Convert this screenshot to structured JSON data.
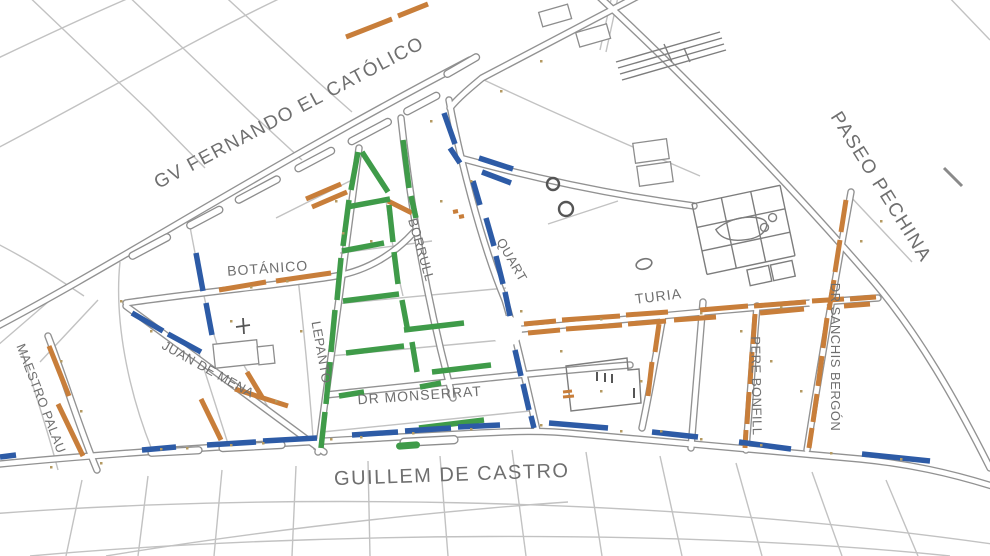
{
  "map": {
    "labels": {
      "gv": {
        "text": "GV FERNANDO EL CATÓLICO"
      },
      "pechina": {
        "text": "PASEO PECHINA"
      },
      "botanico": {
        "text": "BOTÁNICO"
      },
      "borrull": {
        "text": "BORRULL"
      },
      "quart": {
        "text": "QUART"
      },
      "lepanto": {
        "text": "LEPANTO"
      },
      "juan_de_mena": {
        "text": "JUAN DE MENA"
      },
      "maestro_palau": {
        "text": "MAESTRO PALAU"
      },
      "dr_monserrat": {
        "text": "DR MONSERRAT"
      },
      "turia": {
        "text": "TURIA"
      },
      "pere_bonfill": {
        "text": "PERE BONFILL"
      },
      "dr_sanchis_bergon": {
        "text": "DR SANCHIS BERGÓN"
      },
      "guillem_de_castro": {
        "text": "GUILLEM DE CASTRO"
      }
    },
    "colors": {
      "orange": "#c87e3a",
      "green": "#3f9b49",
      "blue": "#2d5ba6",
      "street_gray": "#929292",
      "label_gray": "#6f6f6f"
    },
    "segments": {
      "orange": [
        [
          346,
          37,
          392,
          19
        ],
        [
          398,
          16,
          428,
          4
        ],
        [
          306,
          199,
          341,
          184
        ],
        [
          312,
          207,
          347,
          192
        ],
        [
          219,
          290,
          266,
          282
        ],
        [
          276,
          281,
          331,
          273
        ],
        [
          388,
          201,
          412,
          213
        ],
        [
          49,
          346,
          69,
          396
        ],
        [
          58,
          404,
          83,
          456
        ],
        [
          201,
          399,
          221,
          440
        ],
        [
          235,
          389,
          288,
          406
        ],
        [
          247,
          372,
          262,
          397
        ],
        [
          524,
          324,
          556,
          321
        ],
        [
          562,
          320,
          620,
          316
        ],
        [
          626,
          315,
          668,
          312
        ],
        [
          700,
          310,
          748,
          306
        ],
        [
          754,
          306,
          806,
          302
        ],
        [
          812,
          301,
          844,
          299
        ],
        [
          850,
          299,
          876,
          297
        ],
        [
          528,
          333,
          560,
          330
        ],
        [
          566,
          329,
          622,
          325
        ],
        [
          628,
          324,
          666,
          321
        ],
        [
          674,
          320,
          716,
          317
        ],
        [
          760,
          313,
          804,
          309
        ],
        [
          844,
          306,
          870,
          304
        ],
        [
          846,
          200,
          841,
          232
        ],
        [
          840,
          240,
          835,
          272
        ],
        [
          834,
          280,
          829,
          310
        ],
        [
          827,
          318,
          823,
          348
        ],
        [
          822,
          356,
          818,
          386
        ],
        [
          817,
          394,
          813,
          422
        ],
        [
          812,
          428,
          809,
          448
        ],
        [
          755,
          314,
          753,
          344
        ],
        [
          752,
          352,
          750,
          384
        ],
        [
          749,
          392,
          747,
          424
        ],
        [
          746,
          430,
          745,
          448
        ],
        [
          659,
          324,
          655,
          352
        ],
        [
          652,
          362,
          648,
          396
        ],
        [
          453,
          212,
          458,
          211,
          4
        ],
        [
          459,
          217,
          464,
          216,
          4
        ],
        [
          563,
          392,
          572,
          391,
          3
        ],
        [
          563,
          397,
          574,
          396,
          3
        ]
      ],
      "green": [
        [
          358,
          152,
          351,
          190
        ],
        [
          349,
          200,
          343,
          246
        ],
        [
          341,
          258,
          337,
          300
        ],
        [
          335,
          310,
          331,
          352
        ],
        [
          330,
          362,
          326,
          404
        ],
        [
          325,
          412,
          321,
          448
        ],
        [
          362,
          152,
          388,
          192
        ],
        [
          389,
          205,
          393,
          242
        ],
        [
          394,
          252,
          398,
          284
        ],
        [
          402,
          300,
          408,
          332
        ],
        [
          412,
          342,
          417,
          372
        ],
        [
          403,
          140,
          409,
          188
        ],
        [
          411,
          196,
          416,
          218
        ],
        [
          347,
          207,
          390,
          199
        ],
        [
          342,
          251,
          384,
          243
        ],
        [
          343,
          301,
          399,
          294
        ],
        [
          404,
          330,
          464,
          323
        ],
        [
          346,
          353,
          404,
          346
        ],
        [
          432,
          372,
          491,
          365
        ],
        [
          339,
          396,
          364,
          392
        ],
        [
          420,
          387,
          441,
          383
        ],
        [
          419,
          428,
          484,
          420
        ]
      ],
      "blue": [
        [
          444,
          113,
          455,
          144
        ],
        [
          450,
          148,
          460,
          163
        ],
        [
          479,
          158,
          513,
          169
        ],
        [
          482,
          172,
          511,
          183
        ],
        [
          473,
          181,
          480,
          205
        ],
        [
          486,
          218,
          494,
          246
        ],
        [
          496,
          256,
          503,
          284
        ],
        [
          505,
          292,
          510,
          316
        ],
        [
          515,
          350,
          521,
          376
        ],
        [
          523,
          384,
          529,
          410
        ],
        [
          531,
          416,
          534,
          428
        ],
        [
          132,
          313,
          163,
          331
        ],
        [
          168,
          334,
          201,
          352
        ],
        [
          196,
          253,
          203,
          291
        ],
        [
          206,
          303,
          212,
          335
        ],
        [
          0,
          457,
          16,
          455
        ],
        [
          142,
          450,
          176,
          447
        ],
        [
          207,
          445,
          256,
          442
        ],
        [
          263,
          441,
          317,
          438
        ],
        [
          352,
          435,
          398,
          432
        ],
        [
          405,
          431,
          451,
          428
        ],
        [
          458,
          427,
          500,
          425
        ],
        [
          549,
          423,
          608,
          428
        ],
        [
          652,
          432,
          698,
          437
        ],
        [
          739,
          442,
          791,
          449
        ],
        [
          862,
          454,
          930,
          461
        ]
      ]
    }
  }
}
